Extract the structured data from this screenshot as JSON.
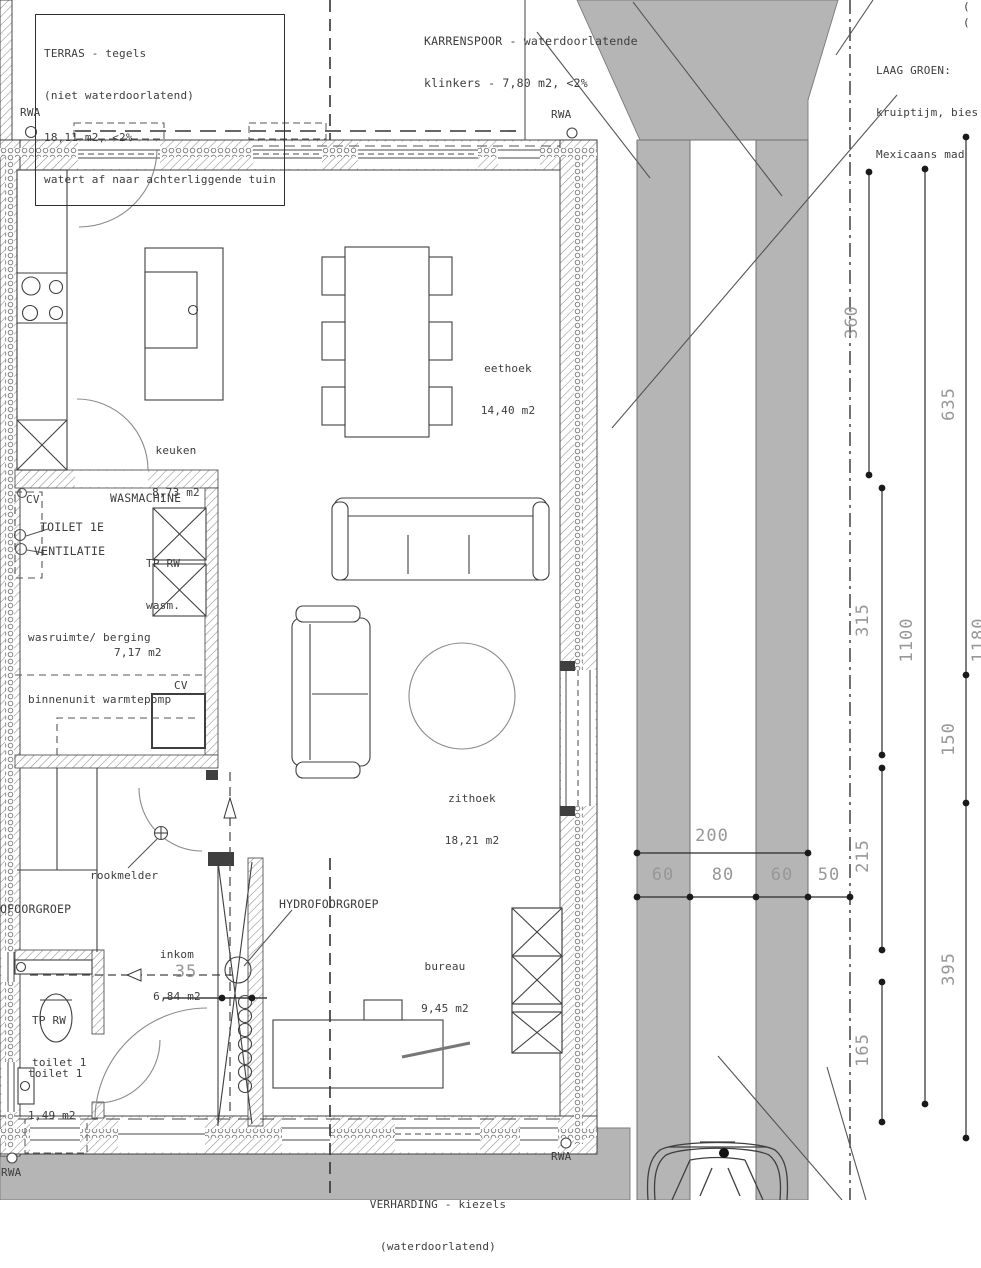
{
  "colors": {
    "paving_gray": "#b5b5b5",
    "line": "#3f3f3f",
    "dim_text": "#979797"
  },
  "notes": {
    "terras": {
      "l1": "TERRAS - tegels",
      "l2": "(niet waterdoorlatend)",
      "l3": "18,11 m2, <2%",
      "l4": "watert af naar achterliggende tuin"
    },
    "karrenspoor": {
      "l1": "KARRENSPOOR - waterdoorlatende",
      "l2": "klinkers - 7,80 m2, <2%"
    },
    "laag_groen": {
      "l1": "LAAG GROEN:",
      "l2": "kruiptijm, bies",
      "l3": "Mexicaans mad"
    },
    "verharding": {
      "l1": "VERHARDING - kiezels",
      "l2": "(waterdoorlatend)"
    },
    "edge_cut_1": "(",
    "edge_cut_2": "("
  },
  "rwa": {
    "label": "RWA"
  },
  "rooms": {
    "keuken": {
      "name": "keuken",
      "area": "8,73 m2"
    },
    "eethoek": {
      "name": "eethoek",
      "area": "14,40 m2"
    },
    "zithoek": {
      "name": "zithoek",
      "area": "18,21 m2"
    },
    "wasruimte": {
      "name": "wasruimte/ berging",
      "area": "7,17 m2"
    },
    "inkom": {
      "name": "inkom",
      "area": "6,84 m2"
    },
    "bureau": {
      "name": "bureau",
      "area": "9,45 m2"
    },
    "toilet": {
      "name": "toilet 1",
      "area": "1,49 m2"
    }
  },
  "equipment": {
    "cv1": "CV",
    "toilet_1e": "TOILET 1E",
    "ventilatie": "VENTILATIE",
    "wasmachine": "WASMACHINE",
    "tp_rw_wasm_1": "TP RW",
    "tp_rw_wasm_2": "wasm.",
    "cv2": "CV",
    "binnenunit": "binnenunit warmtepomp",
    "rookmelder": "rookmelder",
    "hydrofoorgroep_left": "OFOORGROEP",
    "hydrofoorgroep": "HYDROFOORGROEP",
    "tp_rw_toilet_1": "TP RW",
    "tp_rw_toilet_2": "toilet 1"
  },
  "dimensions": {
    "v360": "360",
    "v635": "635",
    "v315": "315",
    "v1100": "1100",
    "v150": "150",
    "v215": "215",
    "v165": "165",
    "v395": "395",
    "v1180": "1180",
    "h200": "200",
    "h60a": "60",
    "h80": "80",
    "h60b": "60",
    "h50": "50",
    "d35": "35"
  }
}
